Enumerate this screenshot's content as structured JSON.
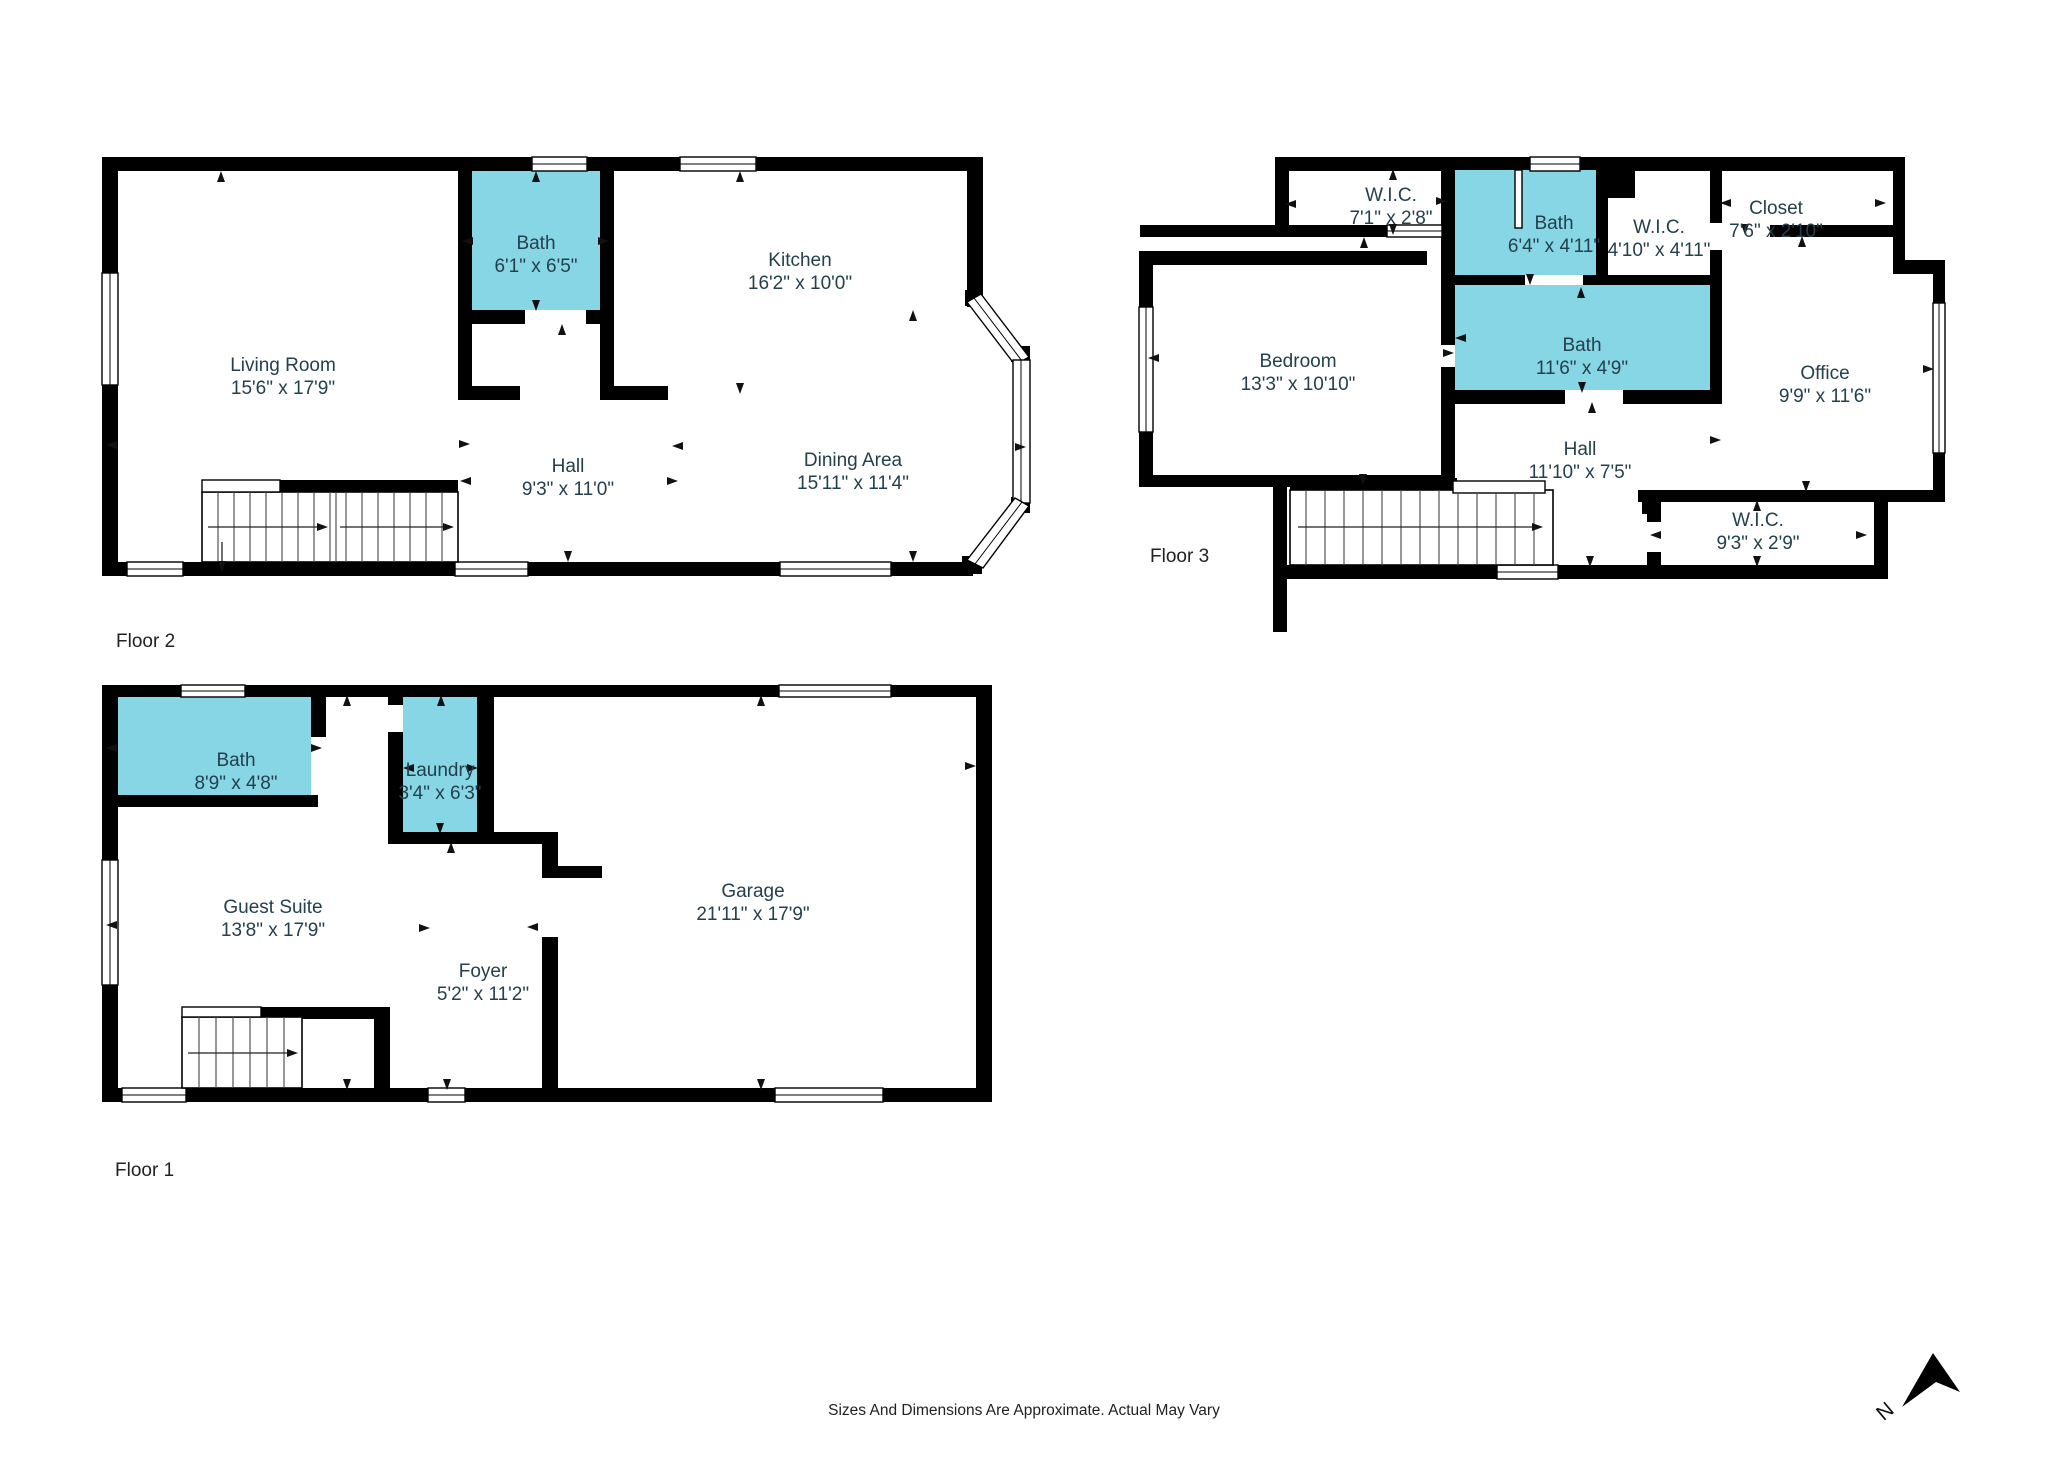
{
  "title": "Three-floor residential floor plan",
  "floors": [
    {
      "label": "Floor 2",
      "rooms": [
        {
          "name": "Living Room",
          "dims": "15'6\" x 17'9\""
        },
        {
          "name": "Bath",
          "dims": "6'1\" x 6'5\"",
          "wet": true
        },
        {
          "name": "Kitchen",
          "dims": "16'2\" x 10'0\""
        },
        {
          "name": "Hall",
          "dims": "9'3\" x 11'0\""
        },
        {
          "name": "Dining Area",
          "dims": "15'11\" x 11'4\""
        }
      ]
    },
    {
      "label": "Floor 3",
      "rooms": [
        {
          "name": "W.I.C.",
          "dims": "7'1\" x 2'8\""
        },
        {
          "name": "Bath",
          "dims": "6'4\" x 4'11\"",
          "wet": true
        },
        {
          "name": "W.I.C.",
          "dims": "4'10\" x 4'11\""
        },
        {
          "name": "Closet",
          "dims": "7'6\" x 2'10\""
        },
        {
          "name": "Bedroom",
          "dims": "13'3\" x 10'10\""
        },
        {
          "name": "Bath",
          "dims": "11'6\" x 4'9\"",
          "wet": true
        },
        {
          "name": "Office",
          "dims": "9'9\" x 11'6\""
        },
        {
          "name": "Hall",
          "dims": "11'10\" x 7'5\""
        },
        {
          "name": "W.I.C.",
          "dims": "9'3\" x 2'9\""
        }
      ]
    },
    {
      "label": "Floor 1",
      "rooms": [
        {
          "name": "Bath",
          "dims": "8'9\" x 4'8\"",
          "wet": true
        },
        {
          "name": "Laundry",
          "dims": "3'4\" x 6'3\"",
          "wet": true
        },
        {
          "name": "Guest Suite",
          "dims": "13'8\" x 17'9\""
        },
        {
          "name": "Foyer",
          "dims": "5'2\" x 11'2\""
        },
        {
          "name": "Garage",
          "dims": "21'11\" x 17'9\""
        }
      ]
    }
  ],
  "footer": {
    "disclaimer": "Sizes And Dimensions Are Approximate. Actual May Vary"
  },
  "compass": {
    "label": "N"
  },
  "colors": {
    "wet_room": "#87D6E5",
    "wall": "#000000",
    "room_label": "#24404C",
    "text": "#222222"
  }
}
